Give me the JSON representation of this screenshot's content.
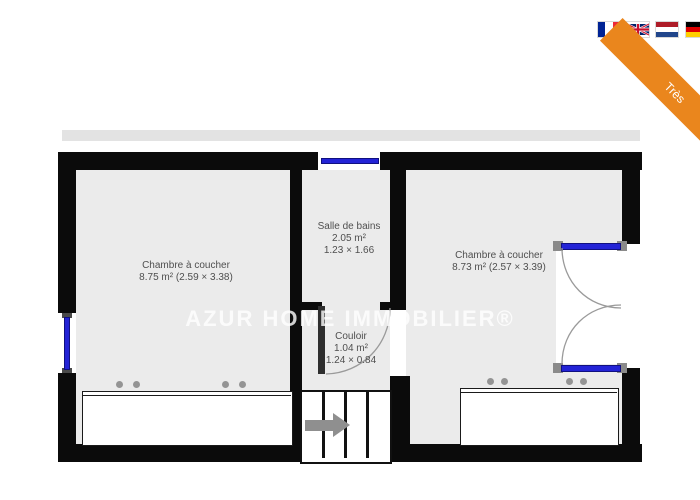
{
  "ribbon": {
    "label": "Très",
    "color": "#EA861D"
  },
  "language_switcher": {
    "flags": [
      {
        "country": "France"
      },
      {
        "country": "United Kingdom"
      },
      {
        "country": "Netherlands"
      },
      {
        "country": "Germany"
      }
    ]
  },
  "floorplan": {
    "watermark": "AZUR HOME IMMOBILIER®",
    "rooms": [
      {
        "name": "Chambre à coucher",
        "area_dims": "8.75 m² (2.59 × 3.38)"
      },
      {
        "name": "Salle de bains",
        "area": "2.05 m²",
        "dims": "1.23 × 1.66"
      },
      {
        "name": "Chambre à coucher",
        "area_dims": "8.73 m² (2.57 × 3.39)"
      },
      {
        "name": "Couloir",
        "area": "1.04 m²",
        "dims": "1.24 × 0.84"
      }
    ],
    "icons": {
      "stairs_arrow": "arrow-right"
    },
    "colors": {
      "wall": "#0b0b0b",
      "floor": "#ebebeb",
      "window_blue": "#2323d6",
      "ribbon_orange": "#EA861D"
    }
  }
}
